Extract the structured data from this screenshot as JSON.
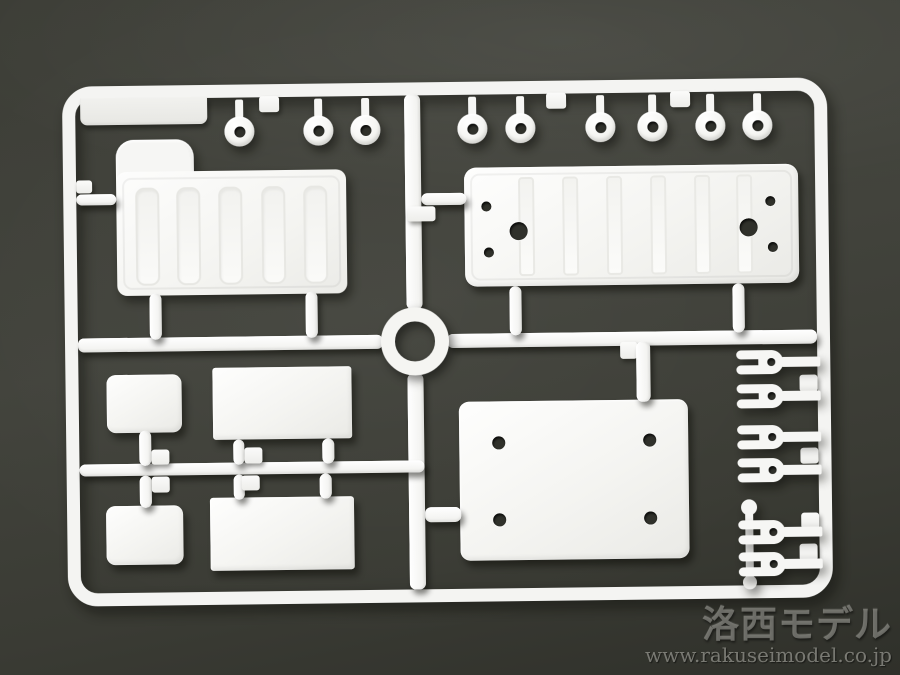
{
  "scene": {
    "description": "Photograph of a white injection-molded plastic model kit sprue (runner frame with parts) lying on a dark olive-gray background"
  },
  "watermark": {
    "logo": "洛西モデル",
    "url": "www.rakuseimodel.co.jp"
  },
  "colors": {
    "background": "#3e3f38",
    "background_corner": "#2f302a",
    "plastic_white": "#f5f5f2",
    "hole_dark": "#30312b",
    "watermark_gray": "#96968f"
  },
  "sprue": {
    "frame": {
      "x": 65,
      "y": 82,
      "w": 765,
      "h": 520,
      "thickness": 13,
      "corner_radius": 30
    },
    "top_rings": {
      "count": 9,
      "x_centers": [
        242,
        321,
        368,
        475,
        523,
        603,
        655,
        713,
        760
      ],
      "y_center": 129,
      "outer_d": 30,
      "hole_d": 11
    },
    "rail_tabs": [
      [
        262,
        94,
        20,
        16
      ],
      [
        549,
        94,
        20,
        16
      ],
      [
        673,
        94,
        20,
        16
      ]
    ],
    "runner_pads": [
      [
        150,
        446,
        18,
        15
      ],
      [
        150,
        473,
        18,
        16
      ],
      [
        243,
        445,
        18,
        16
      ],
      [
        240,
        473,
        18,
        15
      ]
    ],
    "fork_pads": [
      [
        799,
        379,
        18,
        17
      ],
      [
        799,
        452,
        18,
        16
      ],
      [
        799,
        517,
        18,
        16
      ],
      [
        797,
        548,
        18,
        17
      ]
    ],
    "forks": {
      "count": 6,
      "y_centers": [
        366,
        400,
        441,
        474,
        536,
        568
      ]
    },
    "tl_panel": {
      "slots_count": 5,
      "slots_rel_x": [
        19,
        60,
        102,
        145,
        187
      ],
      "slot_w": 24,
      "slot_h": 98
    },
    "tr_plate": {
      "strips_rel_x": [
        54,
        98,
        142,
        186,
        230,
        272
      ],
      "holes": [
        {
          "x": 22,
          "y": 39,
          "d": 10
        },
        {
          "x": 24,
          "y": 85,
          "d": 10
        },
        {
          "x": 54,
          "y": 64,
          "d": 18
        },
        {
          "x": 284,
          "y": 63,
          "d": 18
        },
        {
          "x": 306,
          "y": 37,
          "d": 10
        },
        {
          "x": 308,
          "y": 83,
          "d": 10
        }
      ]
    },
    "br_plate": {
      "holes": [
        {
          "x": 39,
          "y": 41,
          "d": 13
        },
        {
          "x": 190,
          "y": 40,
          "d": 13
        },
        {
          "x": 39,
          "y": 118,
          "d": 13
        },
        {
          "x": 190,
          "y": 118,
          "d": 13
        }
      ]
    }
  }
}
